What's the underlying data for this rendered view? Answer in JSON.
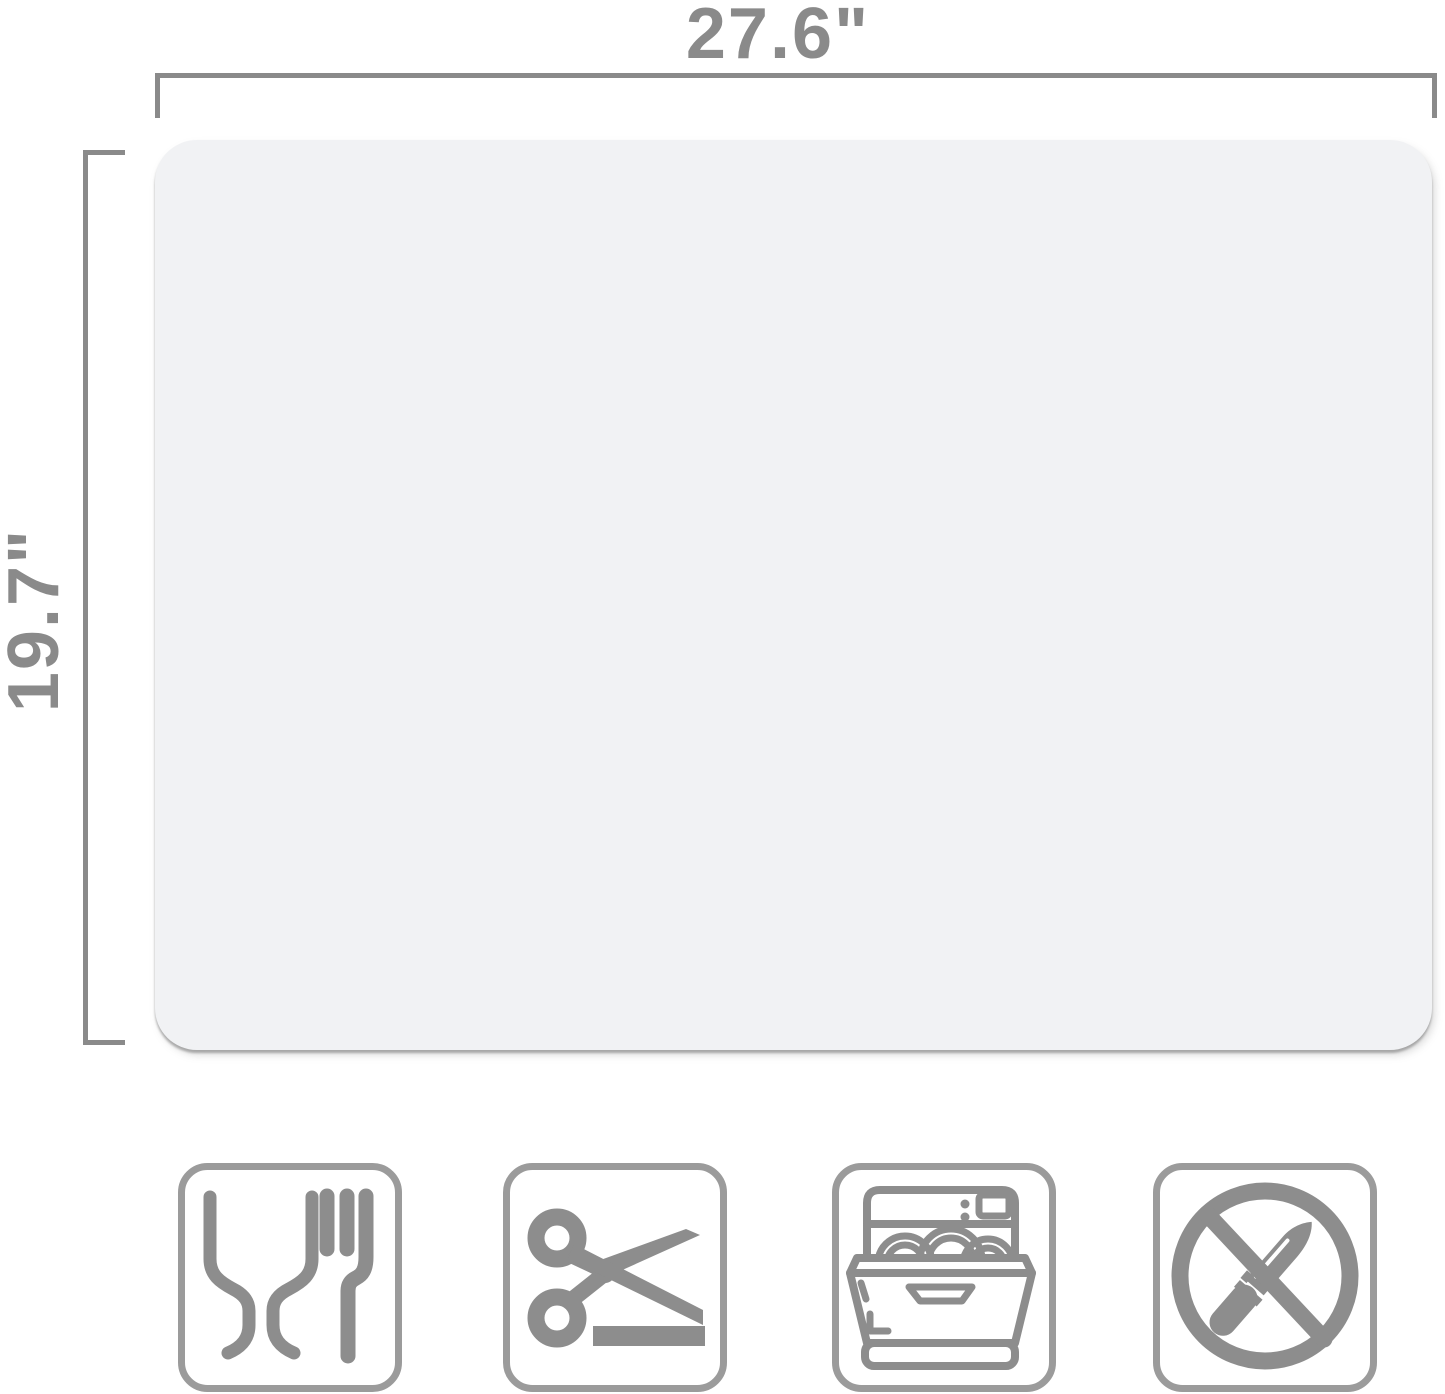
{
  "product_image": {
    "dimension_labels": {
      "width": "27.6\"",
      "height": "19.7\""
    },
    "colors": {
      "background": "#ffffff",
      "dimension_gray": "#8a8a8a",
      "mat_fill": "#f1f2f4",
      "icon_gray": "#8d8d8d",
      "icon_border_gray": "#9b9b9b"
    },
    "icons": [
      {
        "name": "food-safe-icon"
      },
      {
        "name": "scissors-cuttable-icon"
      },
      {
        "name": "dishwasher-safe-icon"
      },
      {
        "name": "no-knife-icon"
      }
    ]
  }
}
